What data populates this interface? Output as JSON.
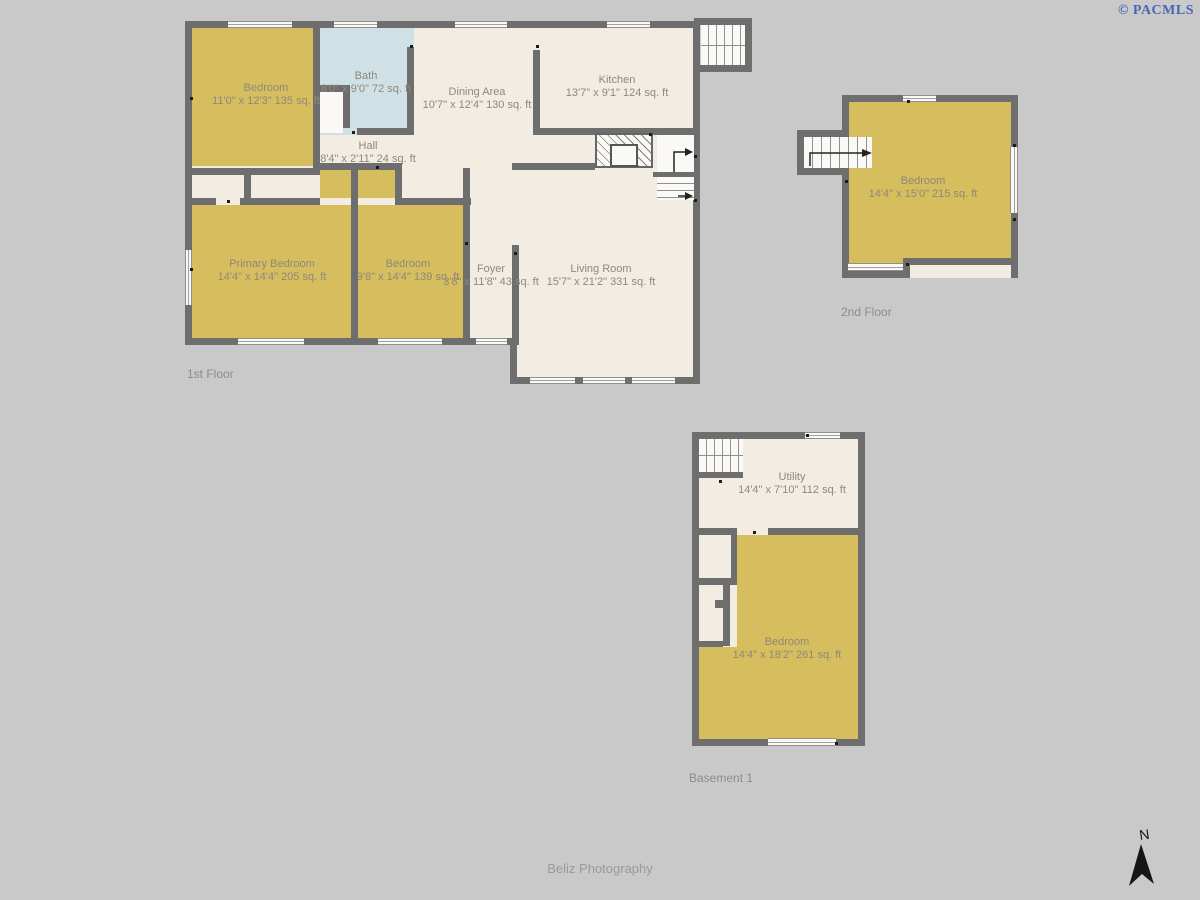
{
  "watermark": {
    "text": "© PACMLS",
    "color": "#4767b3"
  },
  "credit": {
    "text": "Beliz Photography"
  },
  "compass": {
    "label": "N"
  },
  "colors": {
    "background": "#c9c9c9",
    "wall": "#6e6e6e",
    "room_yellow": "#d6bd5e",
    "room_beige": "#f3ece2",
    "room_blue": "#cfe1e4",
    "stairs_white": "#fbf9f6",
    "label_text": "#8f887c"
  },
  "floors": [
    {
      "label": "1st Floor",
      "rooms": [
        {
          "name": "Bedroom",
          "dims": "11'0\" x 12'3\" 135 sq. ft"
        },
        {
          "name": "Bath",
          "dims": "8'0\" x 9'0\" 72 sq. ft"
        },
        {
          "name": "Dining Area",
          "dims": "10'7\" x 12'4\" 130 sq. ft"
        },
        {
          "name": "Kitchen",
          "dims": "13'7\" x 9'1\" 124 sq. ft"
        },
        {
          "name": "Hall",
          "dims": "8'4\" x 2'11\" 24 sq. ft"
        },
        {
          "name": "Primary Bedroom",
          "dims": "14'4\" x 14'4\" 205 sq. ft"
        },
        {
          "name": "Bedroom",
          "dims": "9'8\" x 14'4\" 139 sq. ft"
        },
        {
          "name": "Foyer",
          "dims": "3'8\" x 11'8\" 43 sq. ft"
        },
        {
          "name": "Living Room",
          "dims": "15'7\" x 21'2\" 331 sq. ft"
        }
      ]
    },
    {
      "label": "2nd Floor",
      "rooms": [
        {
          "name": "Bedroom",
          "dims": "14'4\" x 15'0\" 215 sq. ft"
        }
      ]
    },
    {
      "label": "Basement 1",
      "rooms": [
        {
          "name": "Utility",
          "dims": "14'4\" x 7'10\" 112 sq. ft"
        },
        {
          "name": "Bedroom",
          "dims": "14'4\" x 18'2\" 261 sq. ft"
        }
      ]
    }
  ]
}
